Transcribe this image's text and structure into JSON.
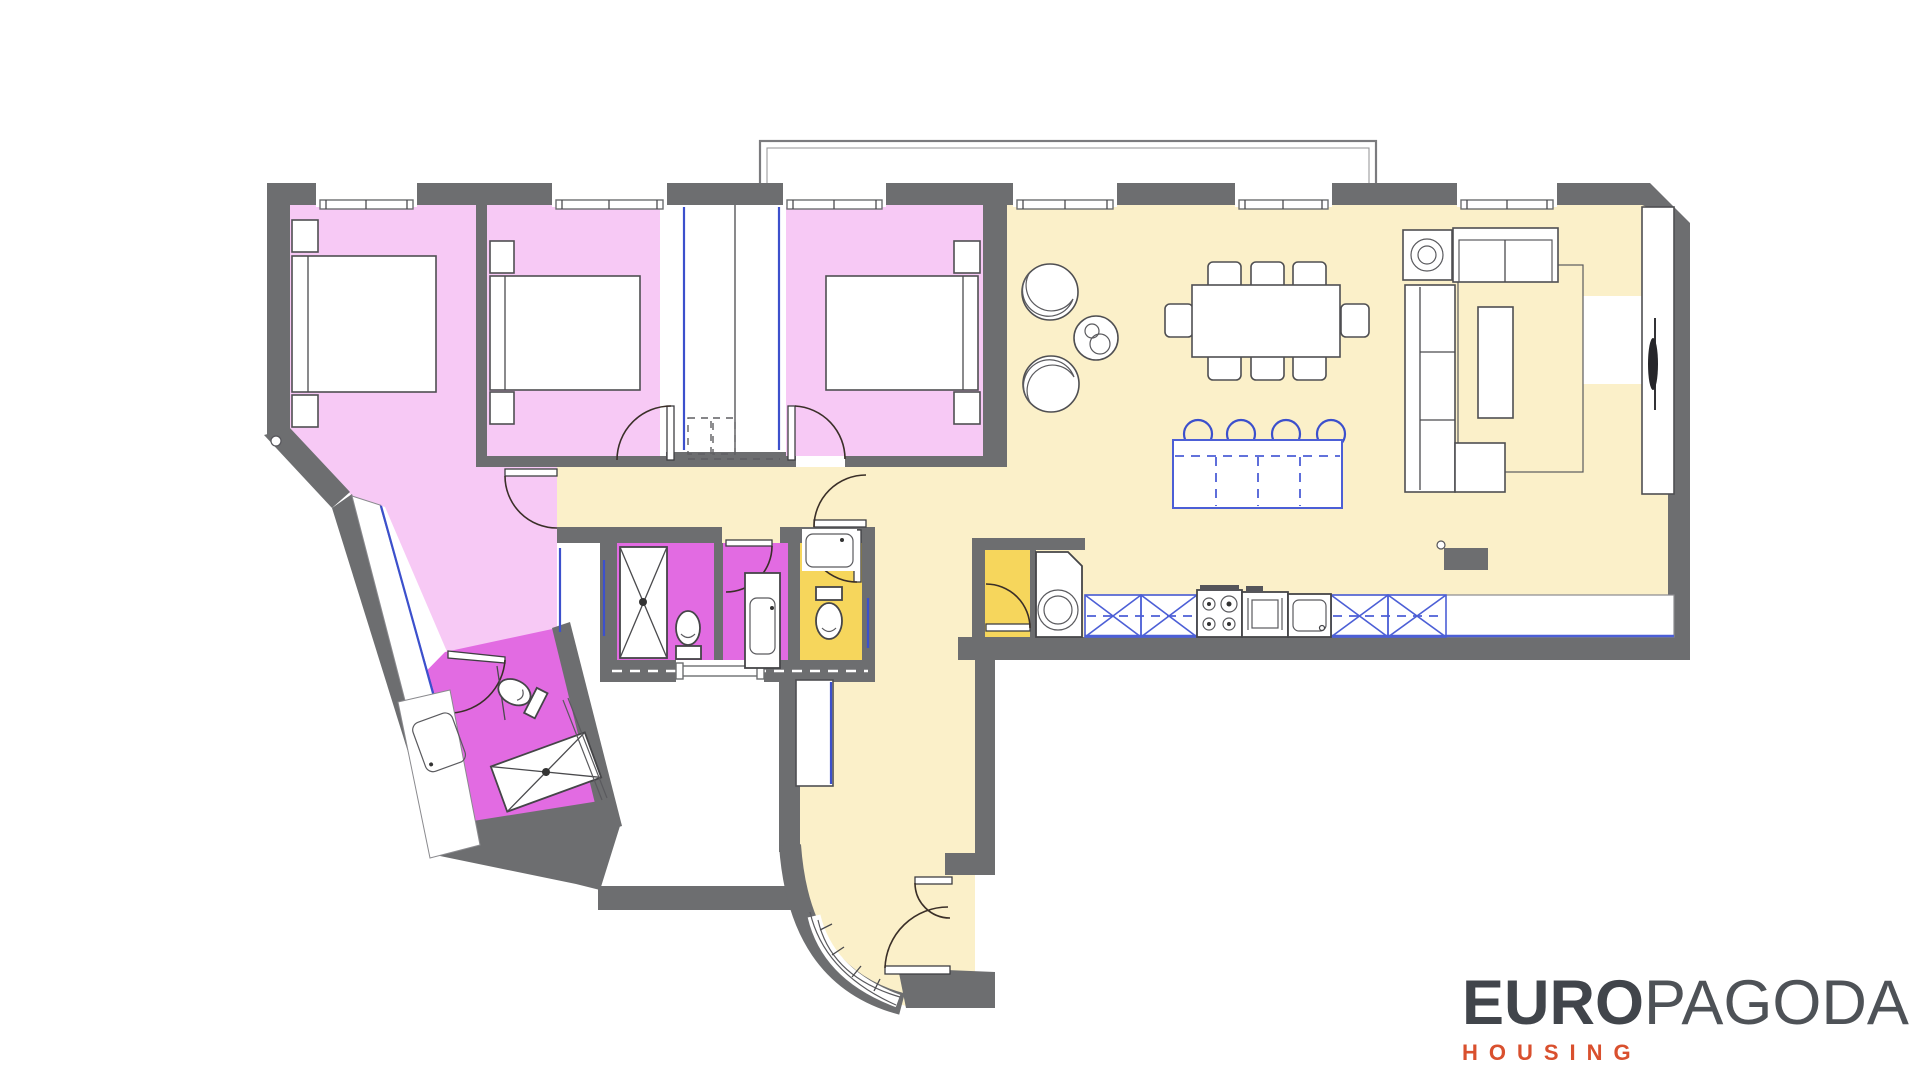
{
  "brand": {
    "logo_primary": "EURO",
    "logo_secondary": "PAGODA",
    "logo_tagline": "HOUSING"
  },
  "palette": {
    "wall_gray": "#6d6e70",
    "bedroom_pink": "#f7c9f5",
    "bathroom_magenta": "#e26be2",
    "wc_yellow": "#f6d65c",
    "floor_cream": "#fbf0c9",
    "white": "#ffffff",
    "accent_blue": "#3c50cc",
    "kitchen_blue": "#4c5fd6",
    "door_swing": "#3a2f28",
    "logo_dark": "#41454b",
    "logo_orange": "#d9502e"
  },
  "rooms": [
    {
      "id": "bedroom-1-master",
      "color_key": "bedroom_pink",
      "furniture": [
        "double-bed",
        "nightstand",
        "nightstand",
        "wardrobe-corridor"
      ]
    },
    {
      "id": "bedroom-2",
      "color_key": "bedroom_pink",
      "furniture": [
        "double-bed",
        "nightstand",
        "nightstand",
        "built-in-wardrobe"
      ]
    },
    {
      "id": "bedroom-3",
      "color_key": "bedroom_pink",
      "furniture": [
        "double-bed",
        "nightstand",
        "nightstand",
        "built-in-wardrobe"
      ]
    },
    {
      "id": "living-dining-kitchen",
      "color_key": "floor_cream",
      "furniture": [
        "armchair",
        "armchair",
        "side-table",
        "dining-table-8-chairs",
        "island-with-4-stools",
        "l-shaped-sofa",
        "loveseat",
        "coffee-table",
        "rug",
        "tv-unit",
        "radiator",
        "kitchen-counter",
        "hob",
        "oven",
        "sink"
      ]
    },
    {
      "id": "pantry-laundry",
      "color_key": "wc_yellow",
      "furniture": [
        "washing-machine"
      ]
    },
    {
      "id": "bathroom-shower",
      "color_key": "bathroom_magenta",
      "furniture": [
        "shower-tray",
        "toilet"
      ]
    },
    {
      "id": "bathroom-2",
      "color_key": "bathroom_magenta",
      "furniture": [
        "vanity-basin"
      ]
    },
    {
      "id": "wc",
      "color_key": "wc_yellow",
      "furniture": [
        "toilet",
        "wash-basin"
      ]
    },
    {
      "id": "ensuite-bathroom",
      "color_key": "bathroom_magenta",
      "furniture": [
        "shower-tray",
        "toilet",
        "vanity-basin"
      ]
    },
    {
      "id": "hall-entry",
      "color_key": "floor_cream",
      "furniture": [
        "closet",
        "curved-glazed-wall",
        "entry-door"
      ]
    },
    {
      "id": "patio-lightwell",
      "color_key": "white",
      "furniture": [
        "window"
      ]
    },
    {
      "id": "balcony",
      "color_key": "white",
      "furniture": []
    }
  ]
}
